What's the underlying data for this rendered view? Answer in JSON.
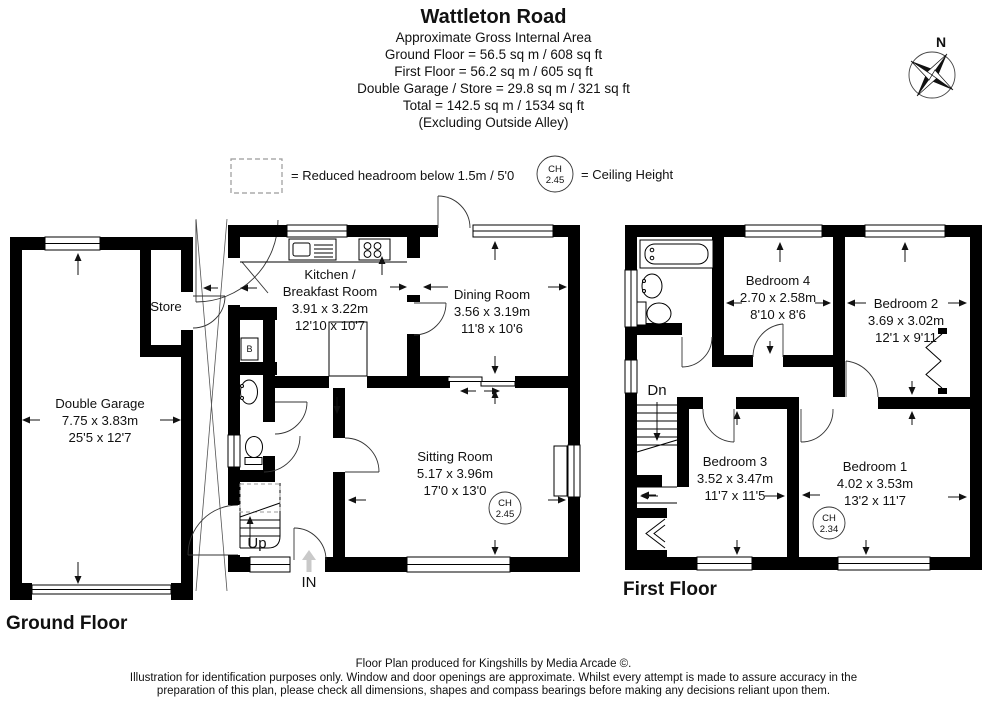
{
  "header": {
    "title": "Wattleton Road",
    "subtitle": "Approximate Gross Internal Area",
    "area_lines": [
      "Ground Floor = 56.5 sq m / 608 sq ft",
      "First Floor = 56.2 sq m / 605 sq ft",
      "Double Garage / Store = 29.8 sq m / 321 sq ft",
      "Total = 142.5 sq m / 1534 sq ft",
      "(Excluding Outside Alley)"
    ]
  },
  "compass": {
    "north_label": "N"
  },
  "legend": {
    "reduced_headroom_text": "= Reduced headroom below 1.5m / 5'0",
    "ch_abbr": "CH",
    "ch_example_value": "2.45",
    "ceiling_height_text": "= Ceiling Height"
  },
  "ground_floor": {
    "floor_label": "Ground Floor",
    "garage": {
      "name": "Double Garage",
      "size_metric": "7.75 x 3.83m",
      "size_imperial": "25'5 x 12'7"
    },
    "store": {
      "name": "Store"
    },
    "kitchen": {
      "name_line1": "Kitchen /",
      "name_line2": "Breakfast Room",
      "size_metric": "3.91 x 3.22m",
      "size_imperial": "12'10 x 10'7"
    },
    "dining": {
      "name": "Dining Room",
      "size_metric": "3.56 x 3.19m",
      "size_imperial": "11'8 x 10'6"
    },
    "sitting": {
      "name": "Sitting Room",
      "size_metric": "5.17 x 3.96m",
      "size_imperial": "17'0 x 13'0",
      "ch_abbr": "CH",
      "ch_value": "2.45"
    },
    "boiler_label": "B",
    "stairs_label": "Up",
    "entrance_label": "IN"
  },
  "first_floor": {
    "floor_label": "First Floor",
    "bedroom1": {
      "name": "Bedroom 1",
      "size_metric": "4.02 x 3.53m",
      "size_imperial": "13'2 x 11'7",
      "ch_abbr": "CH",
      "ch_value": "2.34"
    },
    "bedroom2": {
      "name": "Bedroom 2",
      "size_metric": "3.69 x 3.02m",
      "size_imperial": "12'1 x 9'11"
    },
    "bedroom3": {
      "name": "Bedroom 3",
      "size_metric": "3.52 x 3.47m",
      "size_imperial": "11'7 x 11'5"
    },
    "bedroom4": {
      "name": "Bedroom 4",
      "size_metric": "2.70 x 2.58m",
      "size_imperial": "8'10 x 8'6"
    },
    "stairs_label": "Dn"
  },
  "footer": {
    "line1": "Floor Plan produced for Kingshills by Media Arcade ©.",
    "line2": "Illustration for identification purposes only. Window and door openings are approximate. Whilst every attempt is made to assure accuracy in the",
    "line3": "preparation of this plan, please check all dimensions, shapes and compass bearings before making any decisions reliant upon them."
  }
}
